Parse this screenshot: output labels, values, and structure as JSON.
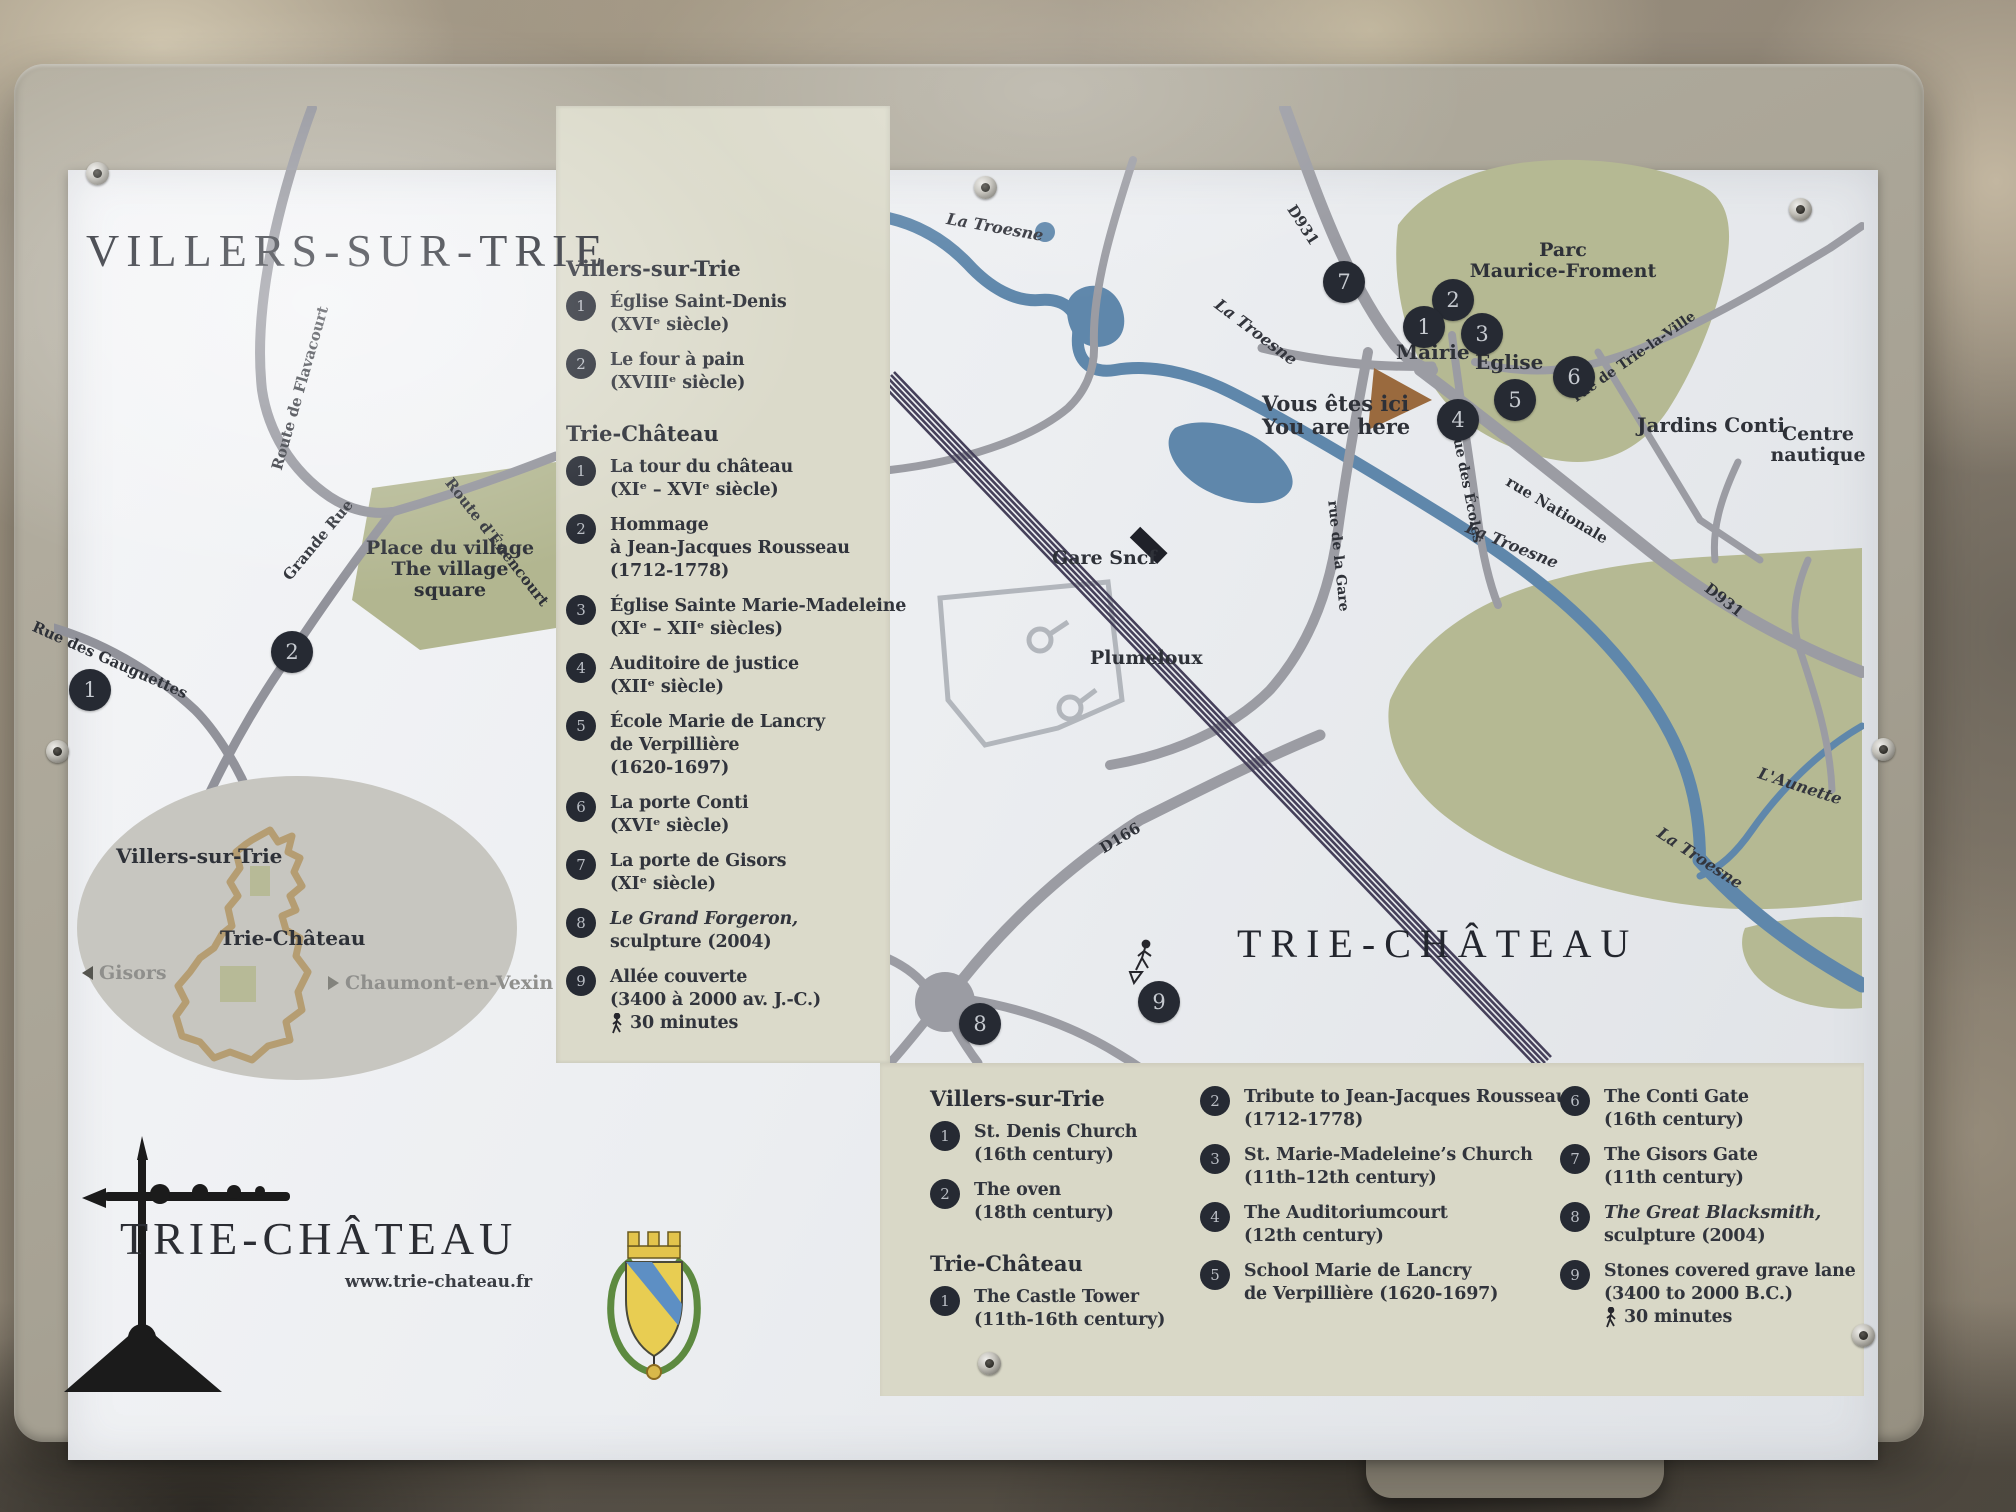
{
  "left_map": {
    "title": "VILLERS-SUR-TRIE",
    "roads": {
      "flavacourt": "Route de Flavacourt",
      "grande_rue": "Grande Rue",
      "enencourt": "Route d'Énencourt",
      "gauguettes": "Rue des Gauguettes"
    },
    "village_square": {
      "line1": "Place du village",
      "line2": "The village",
      "line3": "square"
    },
    "markers": {
      "m1": "1",
      "m2": "2"
    },
    "inset": {
      "villers": "Villers-sur-Trie",
      "trie": "Trie-Château",
      "west": "Gisors",
      "east": "Chaumont-en-Vexin"
    },
    "logo": {
      "title": "TRIE-CHÂTEAU",
      "url": "www.trie-chateau.fr"
    }
  },
  "city_map": {
    "rivers": {
      "troesne": "La Troesne",
      "aunette": "L'Aunette"
    },
    "roads": {
      "d931": "D931",
      "d166": "D166",
      "trie_la_ville": "rue de Trie-la-Ville",
      "nationale": "rue Nationale",
      "ecoles": "rue des Écoles",
      "gare": "rue de la Gare"
    },
    "places": {
      "parc_line1": "Parc",
      "parc_line2": "Maurice-Froment",
      "mairie": "Mairie",
      "eglise": "Église",
      "jardins": "Jardins Conti",
      "centre_line1": "Centre",
      "centre_line2": "nautique",
      "gare_sncf": "Gare Sncf",
      "plumeloux": "Plumeloux",
      "trie_chateau_big": "TRIE-CHÂTEAU"
    },
    "you_are_here": {
      "fr": "Vous êtes ici",
      "en": "You are here"
    },
    "markers": {
      "n1": "1",
      "n2": "2",
      "n3": "3",
      "n4": "4",
      "n5": "5",
      "n6": "6",
      "n7": "7",
      "n8": "8",
      "n9": "9"
    }
  },
  "legend_fr": {
    "villers": {
      "title": "Villers-sur-Trie",
      "items": [
        {
          "n": "1",
          "l1": "Église Saint-Denis",
          "l2": "(XVIᵉ siècle)"
        },
        {
          "n": "2",
          "l1": "Le four à pain",
          "l2": "(XVIIIᵉ siècle)"
        }
      ]
    },
    "trie": {
      "title": "Trie-Château",
      "items": [
        {
          "n": "1",
          "l1": "La tour du château",
          "l2": "(XIᵉ – XVIᵉ siècle)"
        },
        {
          "n": "2",
          "l1": "Hommage",
          "l2": "à Jean-Jacques Rousseau",
          "l3": "(1712-1778)"
        },
        {
          "n": "3",
          "l1": "Église Sainte Marie-Madeleine",
          "l2": "(XIᵉ – XIIᵉ siècles)"
        },
        {
          "n": "4",
          "l1": "Auditoire de justice",
          "l2": "(XIIᵉ siècle)"
        },
        {
          "n": "5",
          "l1": "École Marie de Lancry",
          "l2": "de Verpillière",
          "l3": "(1620-1697)"
        },
        {
          "n": "6",
          "l1": "La porte Conti",
          "l2": "(XVIᵉ siècle)"
        },
        {
          "n": "7",
          "l1": "La porte de Gisors",
          "l2": "(XIᵉ siècle)"
        },
        {
          "n": "8",
          "l1": "Le Grand Forgeron,",
          "l2": "sculpture (2004)"
        },
        {
          "n": "9",
          "l1": "Allée couverte",
          "l2": "(3400 à 2000 av. J.-C.)",
          "walk": "30 minutes"
        }
      ]
    }
  },
  "legend_en": {
    "villers": {
      "title": "Villers-sur-Trie",
      "items": [
        {
          "n": "1",
          "l1": "St. Denis Church",
          "l2": "(16th century)"
        },
        {
          "n": "2",
          "l1": "The oven",
          "l2": "(18th century)"
        }
      ]
    },
    "trie_title": "Trie-Château",
    "trie_item1": {
      "n": "1",
      "l1": "The Castle Tower",
      "l2": "(11th-16th century)"
    },
    "col2": [
      {
        "n": "2",
        "l1": "Tribute to Jean-Jacques Rousseau",
        "l2": "(1712-1778)"
      },
      {
        "n": "3",
        "l1": "St. Marie-Madeleine’s Church",
        "l2": "(11th–12th century)"
      },
      {
        "n": "4",
        "l1": "The Auditoriumcourt",
        "l2": "(12th century)"
      },
      {
        "n": "5",
        "l1": "School Marie de Lancry",
        "l2": "de Verpillière (1620-1697)"
      }
    ],
    "col3": [
      {
        "n": "6",
        "l1": "The Conti Gate",
        "l2": "(16th century)"
      },
      {
        "n": "7",
        "l1": "The Gisors Gate",
        "l2": "(11th century)"
      },
      {
        "n": "8",
        "l1": "The Great Blacksmith,",
        "l2": "sculpture (2004)"
      },
      {
        "n": "9",
        "l1": "Stones covered grave lane",
        "l2": "(3400 to 2000 B.C.)",
        "walk": "30 minutes"
      }
    ]
  },
  "colors": {
    "panel": "#a7a294",
    "legend_bg": "#dbdaca",
    "map_green": "#b5b993",
    "road": "#9b9ca3",
    "river": "#5f87ab",
    "railway": "#45405a",
    "marker": "#262a33",
    "ink": "#2e3138",
    "arrow_brown": "#9a6a3e"
  }
}
